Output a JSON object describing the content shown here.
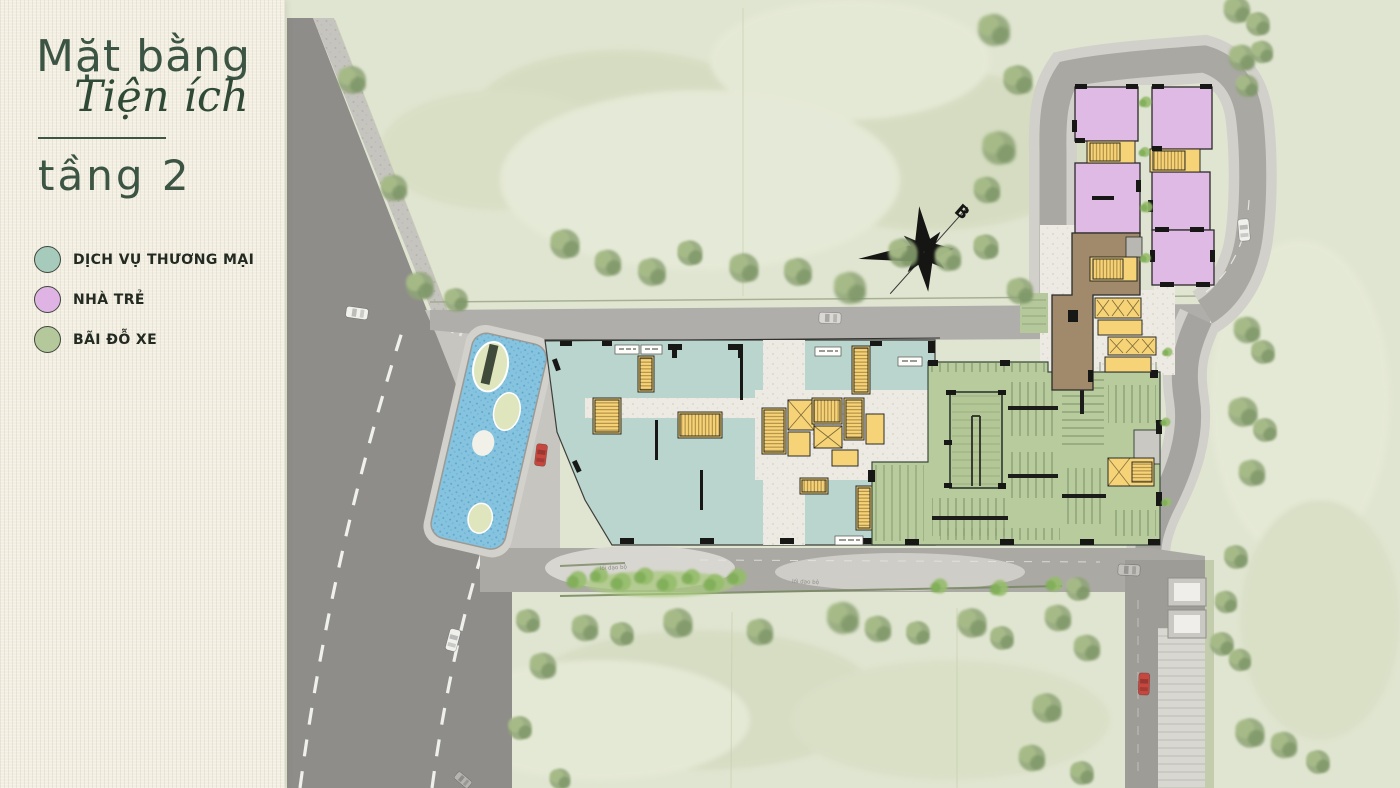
{
  "sidebar": {
    "title_line1": "Mặt bằng",
    "title_line2": "Tiện ích",
    "floor_label": "tầng 2",
    "legend": [
      {
        "label": "DỊCH VỤ THƯƠNG MẠI",
        "color": "#a6cabc"
      },
      {
        "label": "NHÀ TRẺ",
        "color": "#dfb4e4"
      },
      {
        "label": "BÃI ĐỖ XE",
        "color": "#b4c89b"
      }
    ]
  },
  "plan": {
    "compass_label": "B",
    "path_labels": [
      "lối dạo bộ",
      "lối dạo bộ"
    ],
    "colors": {
      "commercial": "#b9d5ce",
      "kindergarten": "#debae4",
      "parking": "#b7cb9c",
      "service_core": "#f6d376",
      "water": "#8ac6e1",
      "grass": "#e0e5d1",
      "road_dark": "#8e8d89",
      "road_light": "#aaa8a3"
    }
  }
}
